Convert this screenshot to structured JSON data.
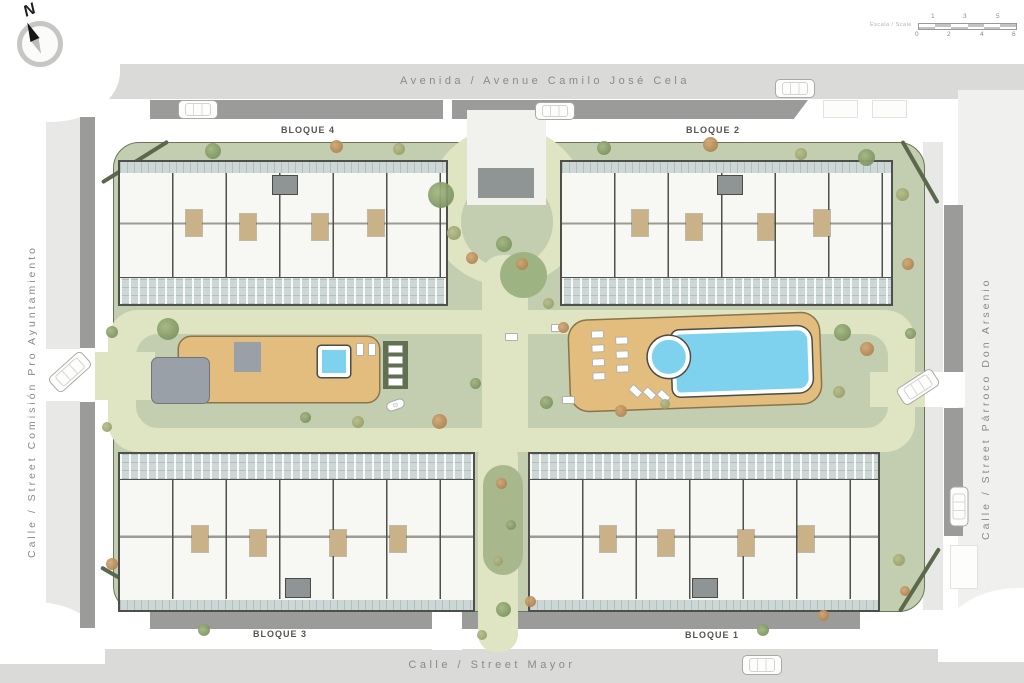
{
  "compass": {
    "north_label": "N"
  },
  "scalebar": {
    "label": "Escala / Scale",
    "top_ticks": [
      "1",
      "3",
      "5"
    ],
    "bottom_ticks": [
      "0",
      "2",
      "4",
      "6"
    ]
  },
  "streets": {
    "top": "Avenida / Avenue Camilo José Cela",
    "bottom": "Calle / Street Mayor",
    "left": "Calle / Street Comisión Pro Ayuntamiento",
    "right": "Calle / Street Párroco Don Arsenio"
  },
  "blocks": {
    "bloque1": "BLOQUE 1",
    "bloque2": "BLOQUE 2",
    "bloque3": "BLOQUE 3",
    "bloque4": "BLOQUE 4"
  },
  "colors": {
    "street_band": "#dadad8",
    "street_side": "#e8e8e6",
    "street_right": "#f0f0ee",
    "parking": "#9b9b99",
    "lawn": "#c3cdb0",
    "path": "#dfe4c3",
    "bed": "#a9b88c",
    "circle_bed": "#9db381",
    "plaza": "#f1f1ed",
    "plaza_block": "#8f9494",
    "building": "#f7f7f4",
    "wall": "#4f4f4b",
    "terrace": "#cdd7d6",
    "bath": "#c9b287",
    "deck": "#e3bd7e",
    "pool": "#7fd2ee",
    "court": "#9aa0a8",
    "pergola": "#5f7150",
    "hedge": "#5b684c",
    "text_street": "#8a8a88",
    "text_block": "#56544e"
  }
}
